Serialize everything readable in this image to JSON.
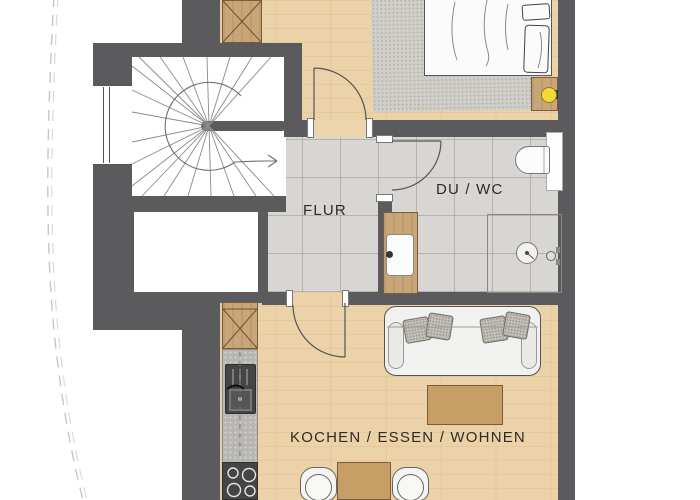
{
  "labels": {
    "flur": "FLUR",
    "du_wc": "DU / WC",
    "kochen": "KOCHEN / ESSEN / WOHNEN"
  },
  "plan": {
    "type": "apartment-floor-plan",
    "rooms": [
      {
        "name": "hallway",
        "label": "FLUR"
      },
      {
        "name": "shower-wc",
        "label": "DU / WC"
      },
      {
        "name": "kitchen-dining-living",
        "label": "KOCHEN / ESSEN / WOHNEN"
      },
      {
        "name": "bedroom",
        "label": ""
      },
      {
        "name": "staircase",
        "label": ""
      }
    ],
    "fixtures": [
      "spiral-staircase",
      "stair-direction-arrow",
      "window",
      "wardrobe-bedroom",
      "bed",
      "area-rug",
      "nightstand",
      "table-lamp",
      "toilet",
      "shower",
      "shower-drain",
      "washbasin-vanity",
      "tall-cabinet-kitchen",
      "kitchen-counter",
      "kitchen-sink",
      "stove",
      "sofa",
      "sofa-pillows",
      "coffee-table",
      "dining-table",
      "chair-left",
      "chair-right",
      "site-boundary-dashed-line"
    ],
    "colors": {
      "wall": "#5b5b5d",
      "wood_floor": "#ebd2a8",
      "tile_floor": "#d8d6d2",
      "furniture_wood": "#c9a678",
      "rug": "#d0cec9",
      "lamp_yellow": "#f2d93a",
      "fixture_white": "#fbfbfb",
      "appliance_dark": "#454545",
      "label_text": "#2f2a26"
    }
  }
}
